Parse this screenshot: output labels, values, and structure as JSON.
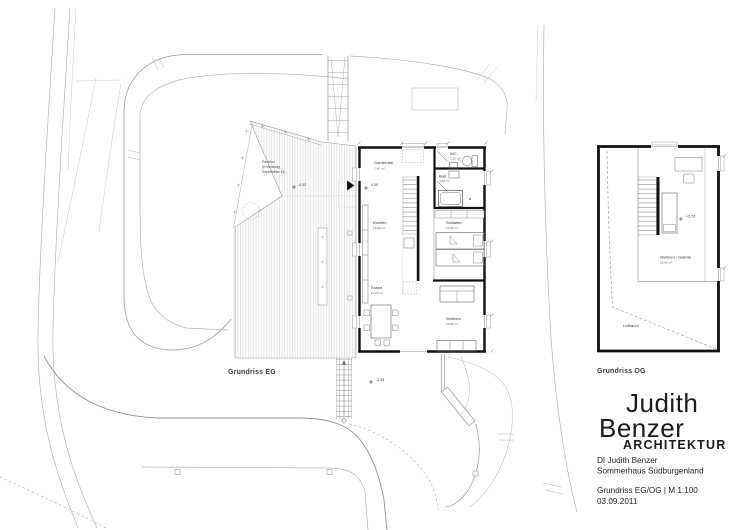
{
  "plans": {
    "eg": {
      "label": "Grundriss EG",
      "pavilion_note": [
        "Pavilion",
        "(Errichtung",
        "September 11)"
      ],
      "levels": {
        "deck": "-0,02",
        "entry": "0,00",
        "terrain": "-2,93"
      },
      "rooms": [
        {
          "name": "Garderobe",
          "area": "7,40 m²"
        },
        {
          "name": "WC",
          "area": "1,50 m²"
        },
        {
          "name": "Bad",
          "area": "4,50 m²"
        },
        {
          "name": "Kochen",
          "area": "15,80 m²"
        },
        {
          "name": "Schlafen",
          "area": "11,80 m²"
        },
        {
          "name": "Essen",
          "area": "11,20 m²"
        },
        {
          "name": "Wohnen",
          "area": "26,80 m²"
        }
      ]
    },
    "og": {
      "label": "Grundriss OG",
      "level": "+2,73",
      "rooms": [
        {
          "name": "Wohnen / Galerie",
          "area": "31,90 m²"
        },
        {
          "name": "Luftraum",
          "area": ""
        }
      ]
    }
  },
  "title_block": {
    "logo": {
      "line1": "Judith",
      "line2": "Benzer",
      "line3": "ARCHITEKTUR"
    },
    "architect": "DI Judith Benzer",
    "project": "Sommerhaus Südburgenland",
    "sheet": "Grundriss EG/OG  |  M 1:100",
    "date": "03.09.2011"
  },
  "colors": {
    "ink": "#1a1a1a",
    "wall": "#111111",
    "line_light": "#b5b5b5",
    "line_mid": "#999999",
    "hatch": "#cccccc"
  }
}
